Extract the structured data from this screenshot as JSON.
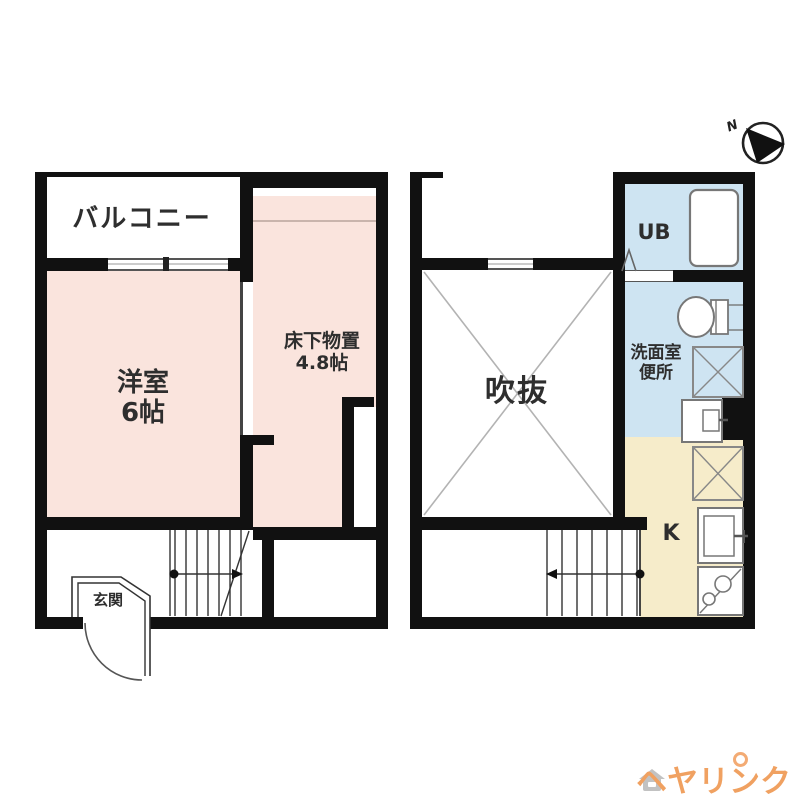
{
  "page": {
    "background": "#ffffff",
    "type": "apartment-floorplan"
  },
  "compass": {
    "label": "N"
  },
  "plan_left": {
    "balcony_label": "バルコニー",
    "bedroom_label_1": "洋室",
    "bedroom_label_2": "6帖",
    "storage_label_1": "床下物置",
    "storage_label_2": "4.8帖",
    "entrance_label": "玄関"
  },
  "plan_right": {
    "void_label": "吹抜",
    "unit_bath_label": "UB",
    "washroom_label_1": "洗面室",
    "washroom_label_2": "便所",
    "kitchen_label": "K"
  },
  "watermark": {
    "brand": "ヘヤリンク",
    "color": "#f0a161"
  },
  "colors": {
    "wall": "#111111",
    "room_pink": "#fae4dd",
    "wet_blue": "#cee4f2",
    "kitchen_cream": "#f6ecca",
    "line_gray": "#999999"
  }
}
